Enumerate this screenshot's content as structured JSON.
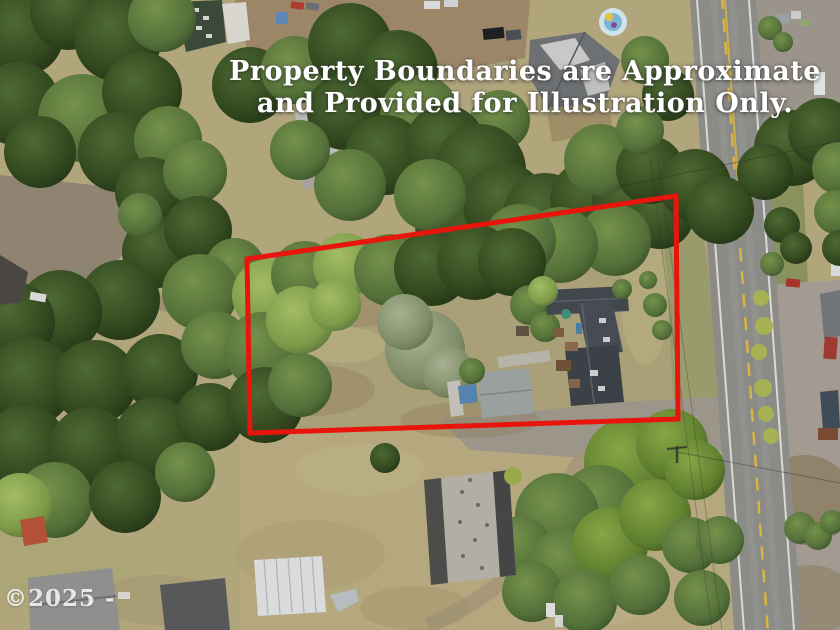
{
  "overlay": {
    "disclaimer_line1": "Property Boundaries are Approximate",
    "disclaimer_line2": "and Provided for Illustration Only.",
    "watermark": "©2025 -",
    "text_color": "#ffffff"
  },
  "boundary": {
    "color": "#e8150d",
    "stroke_width": 5,
    "points": "247,259 676,196 678,419 250,433"
  },
  "road": {
    "surface_color": "#8b8b88",
    "centerline_color": "#d8b440",
    "edge_line_color": "#dad9d2"
  }
}
